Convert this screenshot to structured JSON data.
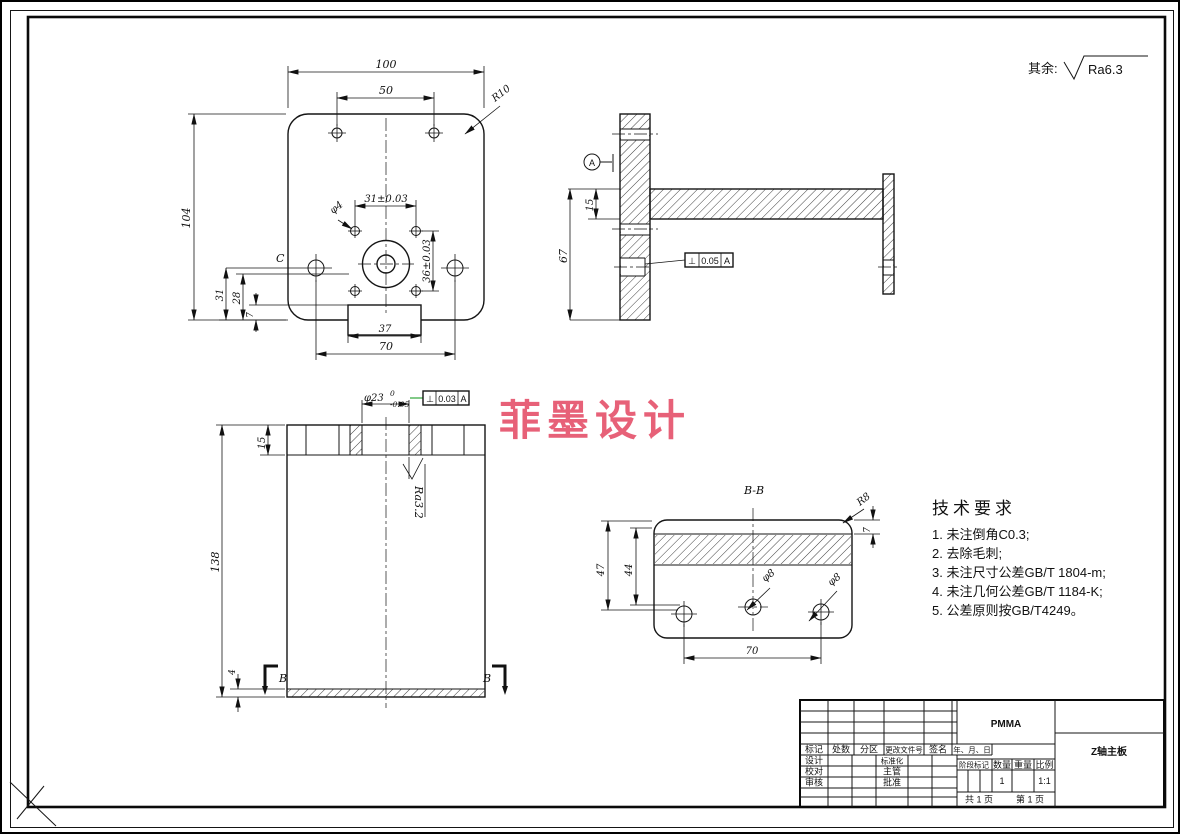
{
  "page": {
    "roughness_note_prefix": "其余:",
    "roughness_note_value": "Ra6.3"
  },
  "watermark": {
    "text": "菲墨设计",
    "color": "#e5506a"
  },
  "front_view": {
    "dim_overall_width": "100",
    "dim_top_hole_spacing": "50",
    "dim_corner_radius": "R10",
    "dim_overall_height": "104",
    "dim_pattern_width": "31±0.03",
    "dim_small_hole": "φ4",
    "dim_pattern_height": "36±0.03",
    "label_c": "C",
    "dim_31": "31",
    "dim_28": "28",
    "dim_7": "7",
    "dim_tab_width": "37",
    "dim_side_hole_spacing": "70"
  },
  "side_view": {
    "datum_label": "A",
    "dim_arm_thickness": "15",
    "dim_height": "67",
    "fcf": {
      "symbol": "⊥",
      "tolerance": "0.05",
      "datum": "A"
    }
  },
  "bottom_view": {
    "dim_bore": "φ23",
    "bore_upper_tol": "0",
    "bore_lower_tol": "-0.05",
    "fcf": {
      "symbol": "⊥",
      "tolerance": "0.03",
      "datum": "A"
    },
    "dim_flange": "15",
    "dim_height": "138",
    "dim_base": "4",
    "roughness": "Ra3.2",
    "section_letter_left": "B",
    "section_letter_right": "B"
  },
  "section_view": {
    "title": "B-B",
    "dim_47": "47",
    "dim_44": "44",
    "dim_radius": "R8",
    "dim_7": "7",
    "dim_hole_mid": "φ8",
    "dim_hole_right": "φ8",
    "dim_hole_spacing": "70"
  },
  "tech_req": {
    "title": "技术要求",
    "items": [
      "1. 未注倒角C0.3;",
      "2. 去除毛刺;",
      "3. 未注尺寸公差GB/T 1804-m;",
      "4. 未注几何公差GB/T 1184-K;",
      "5. 公差原则按GB/T4249。"
    ]
  },
  "title_block": {
    "revision_headers": [
      "标记",
      "处数",
      "分区",
      "更改文件号",
      "签名",
      "年、月、日"
    ],
    "roles_left": [
      "设计",
      "校对",
      "审核"
    ],
    "roles_mid": [
      "标准化",
      "主管",
      "批准"
    ],
    "material": "PMMA",
    "part_name": "Z轴主板",
    "stage_label": "阶段标记",
    "qty_label": "数量",
    "weight_label": "重量",
    "scale_label": "比例",
    "qty_value": "1",
    "scale_value": "1:1",
    "pages_total": "共 1 页",
    "pages_current": "第 1 页"
  }
}
